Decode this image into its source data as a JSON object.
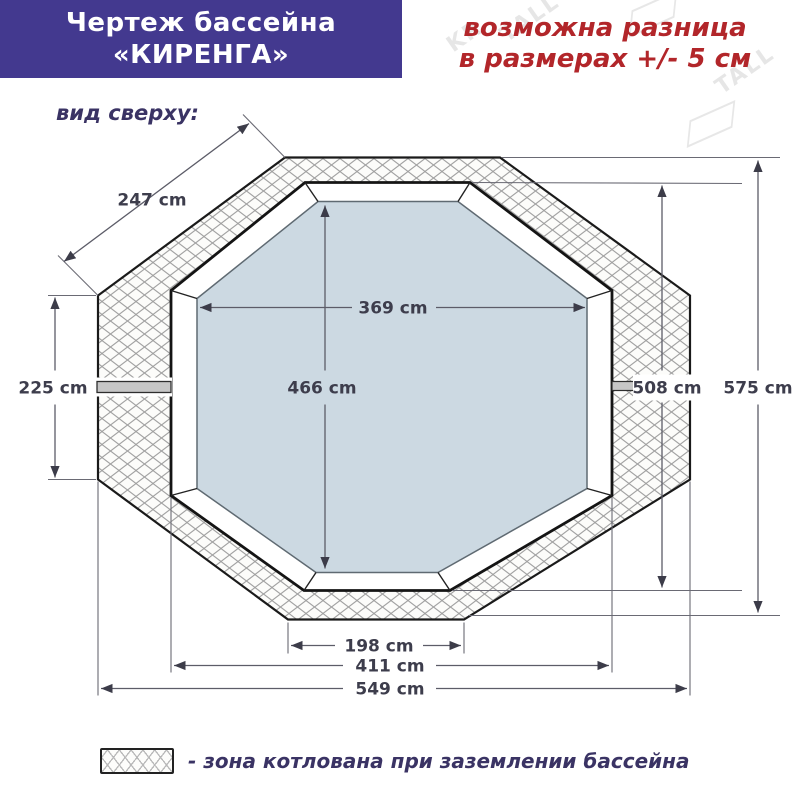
{
  "header": {
    "title_line1": "Чертеж бассейна",
    "title_line2": "«КИРЕНГА»",
    "tolerance_line1": "возможна разница",
    "tolerance_line2": "в размерах +/- 5 см"
  },
  "watermark": {
    "brand": "KRISTALL",
    "fragments": [
      "KR",
      "TALL",
      "TALL"
    ]
  },
  "drawing": {
    "view_label": "вид сверху:",
    "dims": {
      "diagonal_side": "247 cm",
      "left_side": "225 cm",
      "inner_width": "369 cm",
      "inner_height": "466 cm",
      "frame_height": "508 cm",
      "outer_height": "575 cm",
      "bottom_side": "198 cm",
      "frame_width": "411 cm",
      "outer_width": "549 cm"
    }
  },
  "legend": {
    "label": "- зона котлована при заземлении бассейна"
  },
  "colors": {
    "banner": "#43398f",
    "warning_red": "#b2262a",
    "navy_text": "#3a3364",
    "water_fill": "#ccd9e2",
    "hatch_line": "#a2a2a2",
    "seam_gray": "#c6c6c6"
  }
}
